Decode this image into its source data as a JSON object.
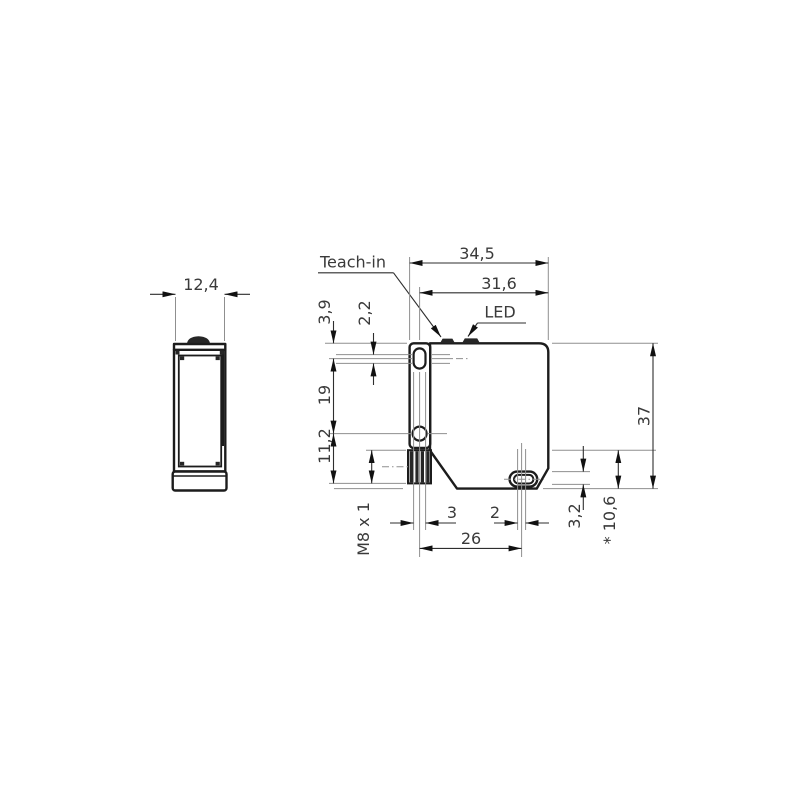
{
  "side_view": {
    "dim_width": "12,4"
  },
  "front_view": {
    "label_teach_in": "Teach-in",
    "label_led": "LED",
    "dim_overall_width": "34,5",
    "dim_body_width": "31,6",
    "dim_top_to_slot": "3,9",
    "dim_slot_offset": "2,2",
    "dim_hole_spacing": "19",
    "dim_hole_to_connector": "11,2",
    "dim_connector_thread": "M8 x 1",
    "dim_slot_width": "3",
    "dim_slot_play": "2",
    "dim_hole_to_slot": "26",
    "dim_slot_height": "3,2",
    "dim_ref_height": "* 10,6",
    "dim_overall_height": "37"
  },
  "colors": {
    "outline": "#1c1c1c",
    "thin_line": "#8f8f8f",
    "text": "#3a3a3a",
    "background": "#ffffff"
  }
}
